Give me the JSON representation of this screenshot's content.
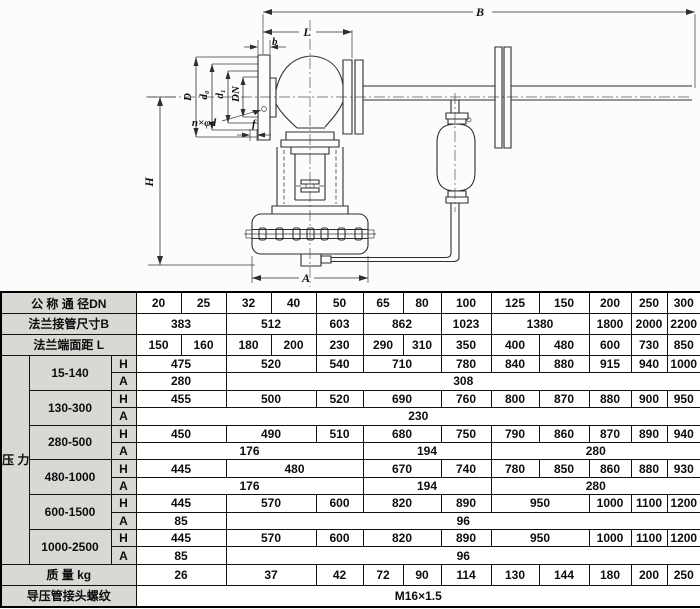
{
  "diagram": {
    "dim_b": "B",
    "dim_l": "L",
    "dim_b_small": "b",
    "dim_f": "f",
    "dim_h": "H",
    "dim_a": "A",
    "dim_flange_od": "D",
    "dim_bolt_circle": "d₀",
    "dim_raised_face": "d₁",
    "dim_bore": "DN",
    "bolt_holes_note": "n×φd"
  },
  "table": {
    "rows": [
      {
        "cells": [
          {
            "t": "公 称 通 径DN",
            "k": "h",
            "c": 3
          },
          {
            "t": "20"
          },
          {
            "t": "25"
          },
          {
            "t": "32"
          },
          {
            "t": "40"
          },
          {
            "t": "50"
          },
          {
            "t": "65"
          },
          {
            "t": "80"
          },
          {
            "t": "100"
          },
          {
            "t": "125"
          },
          {
            "t": "150"
          },
          {
            "t": "200"
          },
          {
            "t": "250"
          },
          {
            "t": "300"
          }
        ]
      },
      {
        "cells": [
          {
            "t": "法兰接管尺寸B",
            "k": "h",
            "c": 3
          },
          {
            "t": "383",
            "c": 2
          },
          {
            "t": "512",
            "c": 2
          },
          {
            "t": "603"
          },
          {
            "t": "862",
            "c": 2
          },
          {
            "t": "1023"
          },
          {
            "t": "1380",
            "c": 2
          },
          {
            "t": "1800"
          },
          {
            "t": "2000"
          },
          {
            "t": "2200"
          }
        ]
      },
      {
        "cells": [
          {
            "t": "法兰端面距  L",
            "k": "h",
            "c": 3
          },
          {
            "t": "150"
          },
          {
            "t": "160"
          },
          {
            "t": "180"
          },
          {
            "t": "200"
          },
          {
            "t": "230"
          },
          {
            "t": "290"
          },
          {
            "t": "310"
          },
          {
            "t": "350"
          },
          {
            "t": "400"
          },
          {
            "t": "480"
          },
          {
            "t": "600"
          },
          {
            "t": "730"
          },
          {
            "t": "850"
          }
        ]
      },
      {
        "cells": [
          {
            "t": "压\n力\n调\n节\n范\n围\nKPa",
            "k": "v",
            "r": 12
          },
          {
            "t": "15-140",
            "k": "g",
            "r": 2
          },
          {
            "t": "H",
            "k": "s"
          },
          {
            "t": "475",
            "c": 2
          },
          {
            "t": "520",
            "c": 2
          },
          {
            "t": "540"
          },
          {
            "t": "710",
            "c": 2
          },
          {
            "t": "780"
          },
          {
            "t": "840"
          },
          {
            "t": "880"
          },
          {
            "t": "915"
          },
          {
            "t": "940"
          },
          {
            "t": "1000"
          }
        ]
      },
      {
        "cells": [
          {
            "t": "A",
            "k": "s"
          },
          {
            "t": "280",
            "c": 2
          },
          {
            "t": "308",
            "c": 11
          }
        ]
      },
      {
        "cells": [
          {
            "t": "130-300",
            "k": "g",
            "r": 2
          },
          {
            "t": "H",
            "k": "s"
          },
          {
            "t": "455",
            "c": 2
          },
          {
            "t": "500",
            "c": 2
          },
          {
            "t": "520"
          },
          {
            "t": "690",
            "c": 2
          },
          {
            "t": "760"
          },
          {
            "t": "800"
          },
          {
            "t": "870"
          },
          {
            "t": "880"
          },
          {
            "t": "900"
          },
          {
            "t": "950"
          }
        ]
      },
      {
        "cells": [
          {
            "t": "A",
            "k": "s"
          },
          {
            "t": "230",
            "c": 13
          }
        ]
      },
      {
        "cells": [
          {
            "t": "280-500",
            "k": "g",
            "r": 2
          },
          {
            "t": "H",
            "k": "s"
          },
          {
            "t": "450",
            "c": 2
          },
          {
            "t": "490",
            "c": 2
          },
          {
            "t": "510"
          },
          {
            "t": "680",
            "c": 2
          },
          {
            "t": "750"
          },
          {
            "t": "790"
          },
          {
            "t": "860"
          },
          {
            "t": "870"
          },
          {
            "t": "890"
          },
          {
            "t": "940"
          }
        ]
      },
      {
        "cells": [
          {
            "t": "A",
            "k": "s"
          },
          {
            "t": "176",
            "c": 5
          },
          {
            "t": "194",
            "c": 3
          },
          {
            "t": "280",
            "c": 5
          }
        ]
      },
      {
        "cells": [
          {
            "t": "480-1000",
            "k": "g",
            "r": 2
          },
          {
            "t": "H",
            "k": "s"
          },
          {
            "t": "445",
            "c": 2
          },
          {
            "t": "480",
            "c": 3
          },
          {
            "t": "670",
            "c": 2
          },
          {
            "t": "740"
          },
          {
            "t": "780"
          },
          {
            "t": "850"
          },
          {
            "t": "860"
          },
          {
            "t": "880"
          },
          {
            "t": "930"
          }
        ]
      },
      {
        "cells": [
          {
            "t": "A",
            "k": "s"
          },
          {
            "t": "176",
            "c": 5
          },
          {
            "t": "194",
            "c": 3
          },
          {
            "t": "280",
            "c": 5
          }
        ]
      },
      {
        "cells": [
          {
            "t": "600-1500",
            "k": "g",
            "r": 2
          },
          {
            "t": "H",
            "k": "s"
          },
          {
            "t": "445",
            "c": 2
          },
          {
            "t": "570",
            "c": 2
          },
          {
            "t": "600"
          },
          {
            "t": "820",
            "c": 2
          },
          {
            "t": "890"
          },
          {
            "t": "950",
            "c": 2
          },
          {
            "t": "1000"
          },
          {
            "t": "1100"
          },
          {
            "t": "1200"
          }
        ]
      },
      {
        "cells": [
          {
            "t": "A",
            "k": "s"
          },
          {
            "t": "85",
            "c": 2
          },
          {
            "t": "96",
            "c": 11
          }
        ]
      },
      {
        "cells": [
          {
            "t": "1000-2500",
            "k": "g",
            "r": 2
          },
          {
            "t": "H",
            "k": "s"
          },
          {
            "t": "445",
            "c": 2
          },
          {
            "t": "570",
            "c": 2
          },
          {
            "t": "600"
          },
          {
            "t": "820",
            "c": 2
          },
          {
            "t": "890"
          },
          {
            "t": "950",
            "c": 2
          },
          {
            "t": "1000"
          },
          {
            "t": "1100"
          },
          {
            "t": "1200"
          }
        ]
      },
      {
        "cells": [
          {
            "t": "A",
            "k": "s"
          },
          {
            "t": "85",
            "c": 2
          },
          {
            "t": "96",
            "c": 11
          }
        ]
      },
      {
        "cells": [
          {
            "t": "质  量  kg",
            "k": "h",
            "c": 3
          },
          {
            "t": "26",
            "c": 2
          },
          {
            "t": "37",
            "c": 2
          },
          {
            "t": "42"
          },
          {
            "t": "72"
          },
          {
            "t": "90"
          },
          {
            "t": "114"
          },
          {
            "t": "130"
          },
          {
            "t": "144"
          },
          {
            "t": "180"
          },
          {
            "t": "200"
          },
          {
            "t": "250"
          }
        ]
      },
      {
        "cells": [
          {
            "t": "导压管接头螺纹",
            "k": "h",
            "c": 3
          },
          {
            "t": "M16×1.5",
            "c": 13
          }
        ]
      }
    ]
  }
}
